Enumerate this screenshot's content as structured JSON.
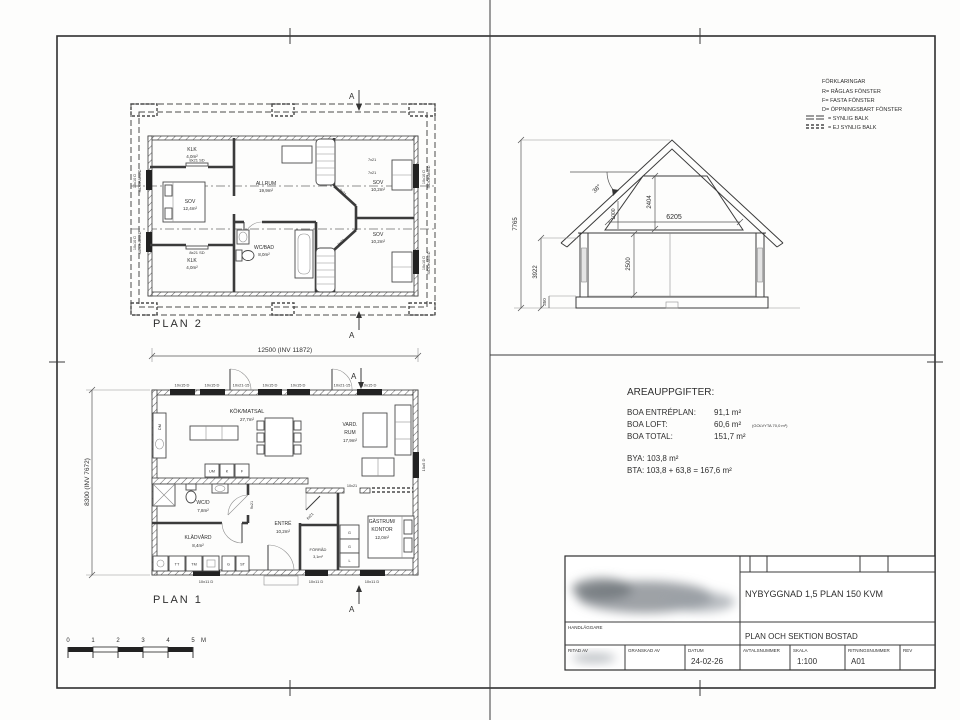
{
  "legend": {
    "title": "FÖRKLARINGAR",
    "window_items": [
      "R= RÅGLAS FÖNSTER",
      "F= FASTA FÖNSTER",
      "D= ÖPPNINGSBART FÖNSTER"
    ],
    "beam_items": [
      "= SYNLIG BALK",
      "= EJ SYNLIG BALK"
    ]
  },
  "section_marker": "A",
  "plan2": {
    "label": "PLAN 2",
    "rooms": {
      "klk_top": {
        "name": "KLK",
        "area": "4,0m²"
      },
      "sov_left": {
        "name": "SOV",
        "area": "12,4m²"
      },
      "allrum": {
        "name": "ALLRUM",
        "area": "19,9m²"
      },
      "sov_right_top": {
        "name": "SOV",
        "area": "10,2m²"
      },
      "sov_right_bottom": {
        "name": "SOV",
        "area": "10,2m²"
      },
      "wcbad": {
        "name": "WC/BAD",
        "area": "8,0m²"
      },
      "klk_bottom": {
        "name": "KLK",
        "area": "4,0m²"
      }
    },
    "door_labels": {
      "top": "8x21 SD",
      "bottom": "8x21 SD",
      "diag1": "9x21",
      "diag2": "9x21",
      "sov1": "7x21",
      "sov2": "7x21"
    },
    "window_labels": {
      "side": "10x10 D",
      "side_type": "SIDOHÄNGD"
    }
  },
  "plan1": {
    "label": "PLAN 1",
    "dim_top": "12500  (INV 11872)",
    "dim_left": "8300  (INV 7672)",
    "rooms": {
      "kok": {
        "name": "KÖK/MATSAL",
        "area": "27,7m²"
      },
      "vardrum": {
        "name": "VARD.",
        "name2": "RUM",
        "area": "17,9m²"
      },
      "wcd": {
        "name": "WC/D",
        "area": "7,8m²"
      },
      "kladvard": {
        "name": "KLÄDVÅRD",
        "area": "8,4m²"
      },
      "entre": {
        "name": "ENTRÉ",
        "area": "10,2m²"
      },
      "forrad": {
        "name": "FÖRRÅD",
        "area": "3,1m²"
      },
      "gastrum": {
        "name": "GÄSTRUM/",
        "name2": "KONTOR",
        "area": "12,0m²"
      }
    },
    "appliances": {
      "dm": "DM",
      "um": "UM",
      "k": "K",
      "f": "F",
      "tt": "TT",
      "tm": "TM",
      "g": "G",
      "st": "ST"
    },
    "closets": [
      "G",
      "G",
      "L"
    ],
    "window_labels": {
      "w1015": "10x15 D",
      "d1021": "10x21-15",
      "w1011": "10x11 D",
      "w105": "10x5 D"
    },
    "door_labels": {
      "d1": "9x21",
      "d2": "10x21",
      "d3": "6x21"
    }
  },
  "section": {
    "dims": {
      "total_height": "7765",
      "wall_height": "3922",
      "plinth": "350",
      "floor_height": "2500",
      "knee": "1000",
      "loft_height": "2404",
      "loft_width": "6205",
      "roof_angle": "38°"
    }
  },
  "areas": {
    "title": "AREAUPPGIFTER:",
    "rows": [
      {
        "label": "BOA  ENTRÉPLAN:",
        "value": "91,1 m²",
        "note": ""
      },
      {
        "label": "BOA  LOFT:",
        "value": "60,6 m²",
        "note": "(GOLVYTA 70,0 m²)"
      },
      {
        "label": "BOA  TOTAL:",
        "value": "151,7 m²",
        "note": ""
      }
    ],
    "extra": [
      "BYA: 103,8 m²",
      "BTA: 103,8 + 63,8 = 167,6 m²"
    ]
  },
  "titleblock": {
    "project_title": "NYBYGGNAD  1,5  PLAN  150  KVM",
    "drawing_title": "PLAN  OCH  SEKTION  BOSTAD",
    "handlaggare_label": "HANDLÄGGARE",
    "ritad_label": "RITAD  AV",
    "granskad_label": "GRANSKAD  AV",
    "datum_label": "DATUM",
    "datum_value": "24-02-26",
    "avtalsnummer_label": "AVTALSNUMMER",
    "skala_label": "SKALA",
    "skala_value": "1:100",
    "ritningsnummer_label": "RITNINGSNUMMER",
    "ritningsnummer_value": "A01",
    "rev_label": "REV"
  },
  "scalebar": {
    "ticks": [
      "0",
      "1",
      "2",
      "3",
      "4",
      "5"
    ],
    "unit": "M"
  }
}
